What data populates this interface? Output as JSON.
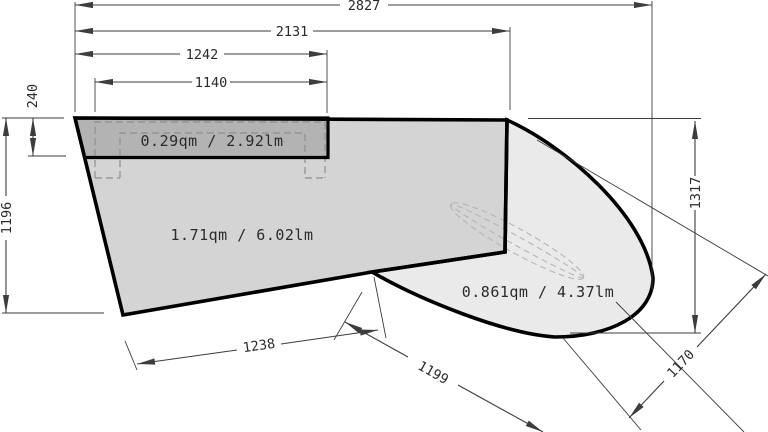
{
  "drawing_title": "countertop-dimension-drawing",
  "dimensions": {
    "overall_width": "2827",
    "width_to_seam": "2131",
    "recess_width_outer": "1242",
    "recess_width_inner": "1140",
    "recess_depth": "240",
    "depth_left": "1196",
    "depth_right": "1317",
    "bottom_edge": "1238",
    "diagonal_lower": "1199",
    "diagonal_right": "1170"
  },
  "area_labels": {
    "recess_panel": "0.29qm / 2.92lm",
    "main_panel": "1.71qm / 6.02lm",
    "curved_panel": "0.861qm / 4.37lm"
  },
  "colors": {
    "background": "#ffffff",
    "main_panel_fill": "#d4d4d4",
    "recess_panel_fill": "#b3b3b3",
    "curved_panel_fill": "#eaeaea",
    "outline": "#000000",
    "dimension_lines": "#3d3d3d",
    "hidden_lines": "#8f8f8f"
  }
}
